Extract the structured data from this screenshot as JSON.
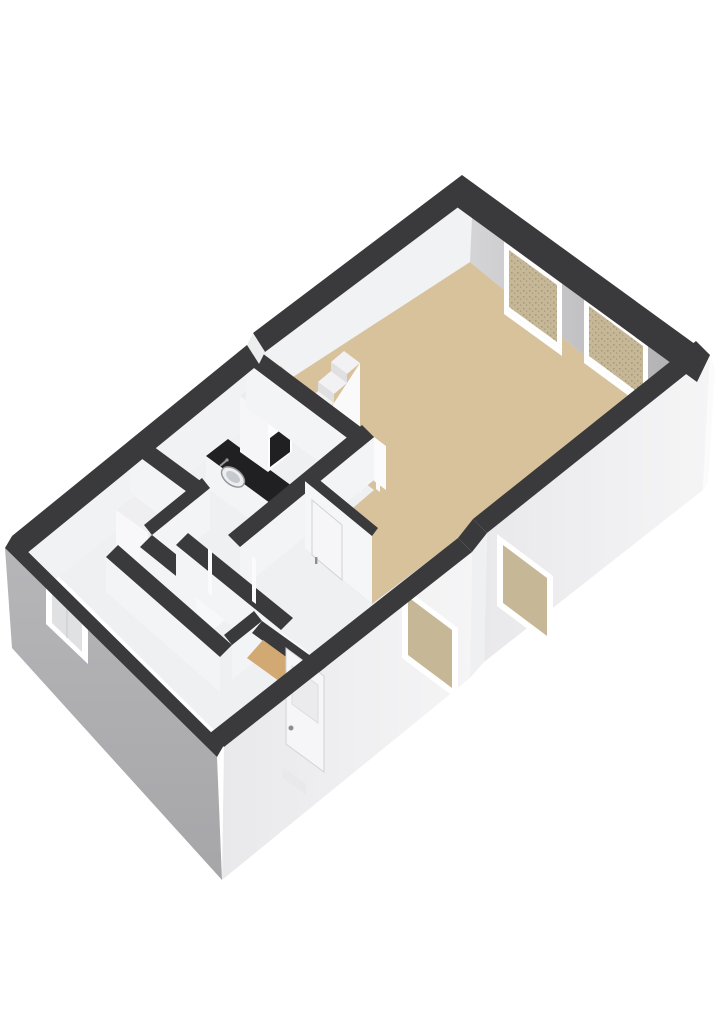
{
  "app": {
    "name": "3d-floorplan-render",
    "description": "Isometric 3D floor plan render of a single-storey apartment on a white background: large living room with beige floor and two windows, kitchen with black countertop and sink, utility area with stacked washer-dryer, entrance hall with front door, toilet, and a small staircase."
  },
  "colors": {
    "background": "#ffffff",
    "wallTop": "#3a3a3c",
    "interiorBase": "#eef0f2",
    "nwFace": "#f1f2f4",
    "neWallLight": "#d8d8da",
    "neWallDark": "#aeaeb1",
    "extGray": "#b6b6b9",
    "extGrayDark": "#a6a6a9",
    "extWhite": "#f5f5f6",
    "extWhiteDark": "#e9e9ec",
    "floorBeige": "#d8c29c",
    "floorTan": "#d2a873",
    "floorWhite": "#f7f8f9",
    "glassBeige": "#c6b897",
    "glassSpeck": "#a79a7c",
    "glassLight": "#e0e1e3",
    "frameWhite": "#ffffff",
    "faceWhite": "#f3f4f6",
    "doorWhite": "#f6f6f8",
    "doorInset": "#ebebee",
    "handleGray": "#8d8d91",
    "counterBlack": "#202023",
    "applianceWhite": "#f8f8fa",
    "applianceShade": "#ececef",
    "drumRing": "#8f8f93",
    "drumMid": "#aeaeb2",
    "drumDark": "#63636a",
    "stairTread": "#f2f2f4",
    "stairRiser": "#e0e0e3",
    "stairSide": "#fafafb"
  },
  "scene": {
    "view": "isometric-3d",
    "rooms": [
      {
        "id": "living-room",
        "floor": "beige",
        "visible_features": [
          "two windows on upper-right wall",
          "staircase",
          "wall jog stub on lower-right wall"
        ]
      },
      {
        "id": "kitchen",
        "floor": "light",
        "visible_features": [
          "tall cabinet",
          "black countertop",
          "sink with faucet"
        ]
      },
      {
        "id": "utility-room",
        "floor": "light",
        "visible_features": [
          "stacked washer-dryer with round door"
        ]
      },
      {
        "id": "entrance-hall",
        "floor": "tan",
        "visible_features": [
          "front door with step",
          "interior door with handle"
        ]
      },
      {
        "id": "toilet-room",
        "floor": "light",
        "visible_features": []
      }
    ],
    "window_count": {
      "ne_wall": 2,
      "se_wall": 2,
      "sw_wall": 1
    },
    "door_count": {
      "exterior": 1,
      "interior": 1
    },
    "stairs_steps_visible": 4
  }
}
